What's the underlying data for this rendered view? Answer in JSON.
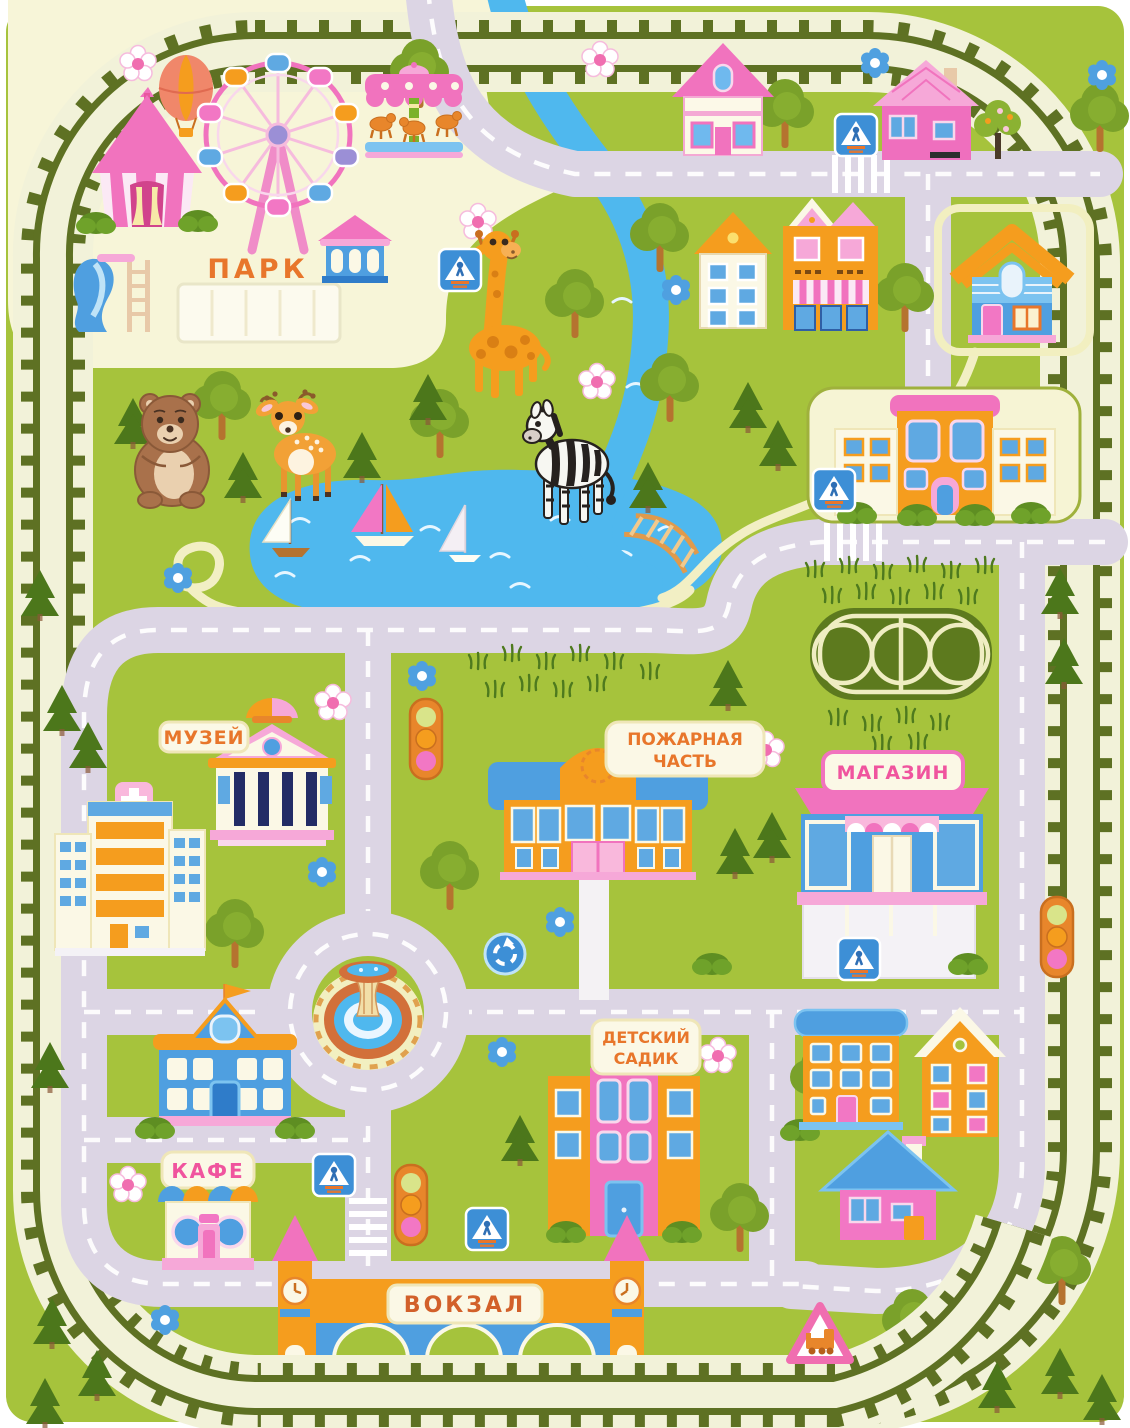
{
  "labels": {
    "park": "ПАРК",
    "museum": "МУЗЕЙ",
    "fire_station_line1": "ПОЖАРНАЯ",
    "fire_station_line2": "ЧАСТЬ",
    "shop": "МАГАЗИН",
    "kindergarten_line1": "ДЕТСКИЙ",
    "kindergarten_line2": "САДИК",
    "cafe": "КАФЕ",
    "station": "ВОКЗАЛ"
  },
  "palette": {
    "grass": "#A6C33C",
    "road": "#DCD5E4",
    "road_dash": "#FFFFFF",
    "track_olive": "#5E7123",
    "track_bed": "#F2F2D9",
    "park_cream": "#F7F5D8",
    "water": "#4FB8EE",
    "pink": "#F173BE",
    "light_pink": "#F9B8DC",
    "orange": "#F59D1E",
    "blue": "#4F9FE0",
    "navy": "#232C66",
    "terracotta": "#D2703A",
    "label_orange": "#E8762B",
    "label_pink": "#F0549E"
  },
  "scene": {
    "type": "children road play mat / toy town map",
    "landmarks": [
      "park with circus tent, ferris wheel, carousel, hot air balloon, slide, pavilion",
      "parking lot",
      "lake with three sailboats",
      "river with wooden footbridge",
      "museum",
      "hospital with cross",
      "fire station",
      "shop with parking",
      "school building in courtyard",
      "basketball court",
      "fountain roundabout",
      "kindergarten",
      "blue school",
      "cafe",
      "railway station with clock towers",
      "residential houses",
      "railway ring around the town"
    ],
    "animals": [
      "bear",
      "fawn",
      "giraffe",
      "zebra"
    ],
    "signs": [
      "pedestrian-crossing",
      "roundabout",
      "railway-crossing",
      "traffic-light"
    ]
  }
}
